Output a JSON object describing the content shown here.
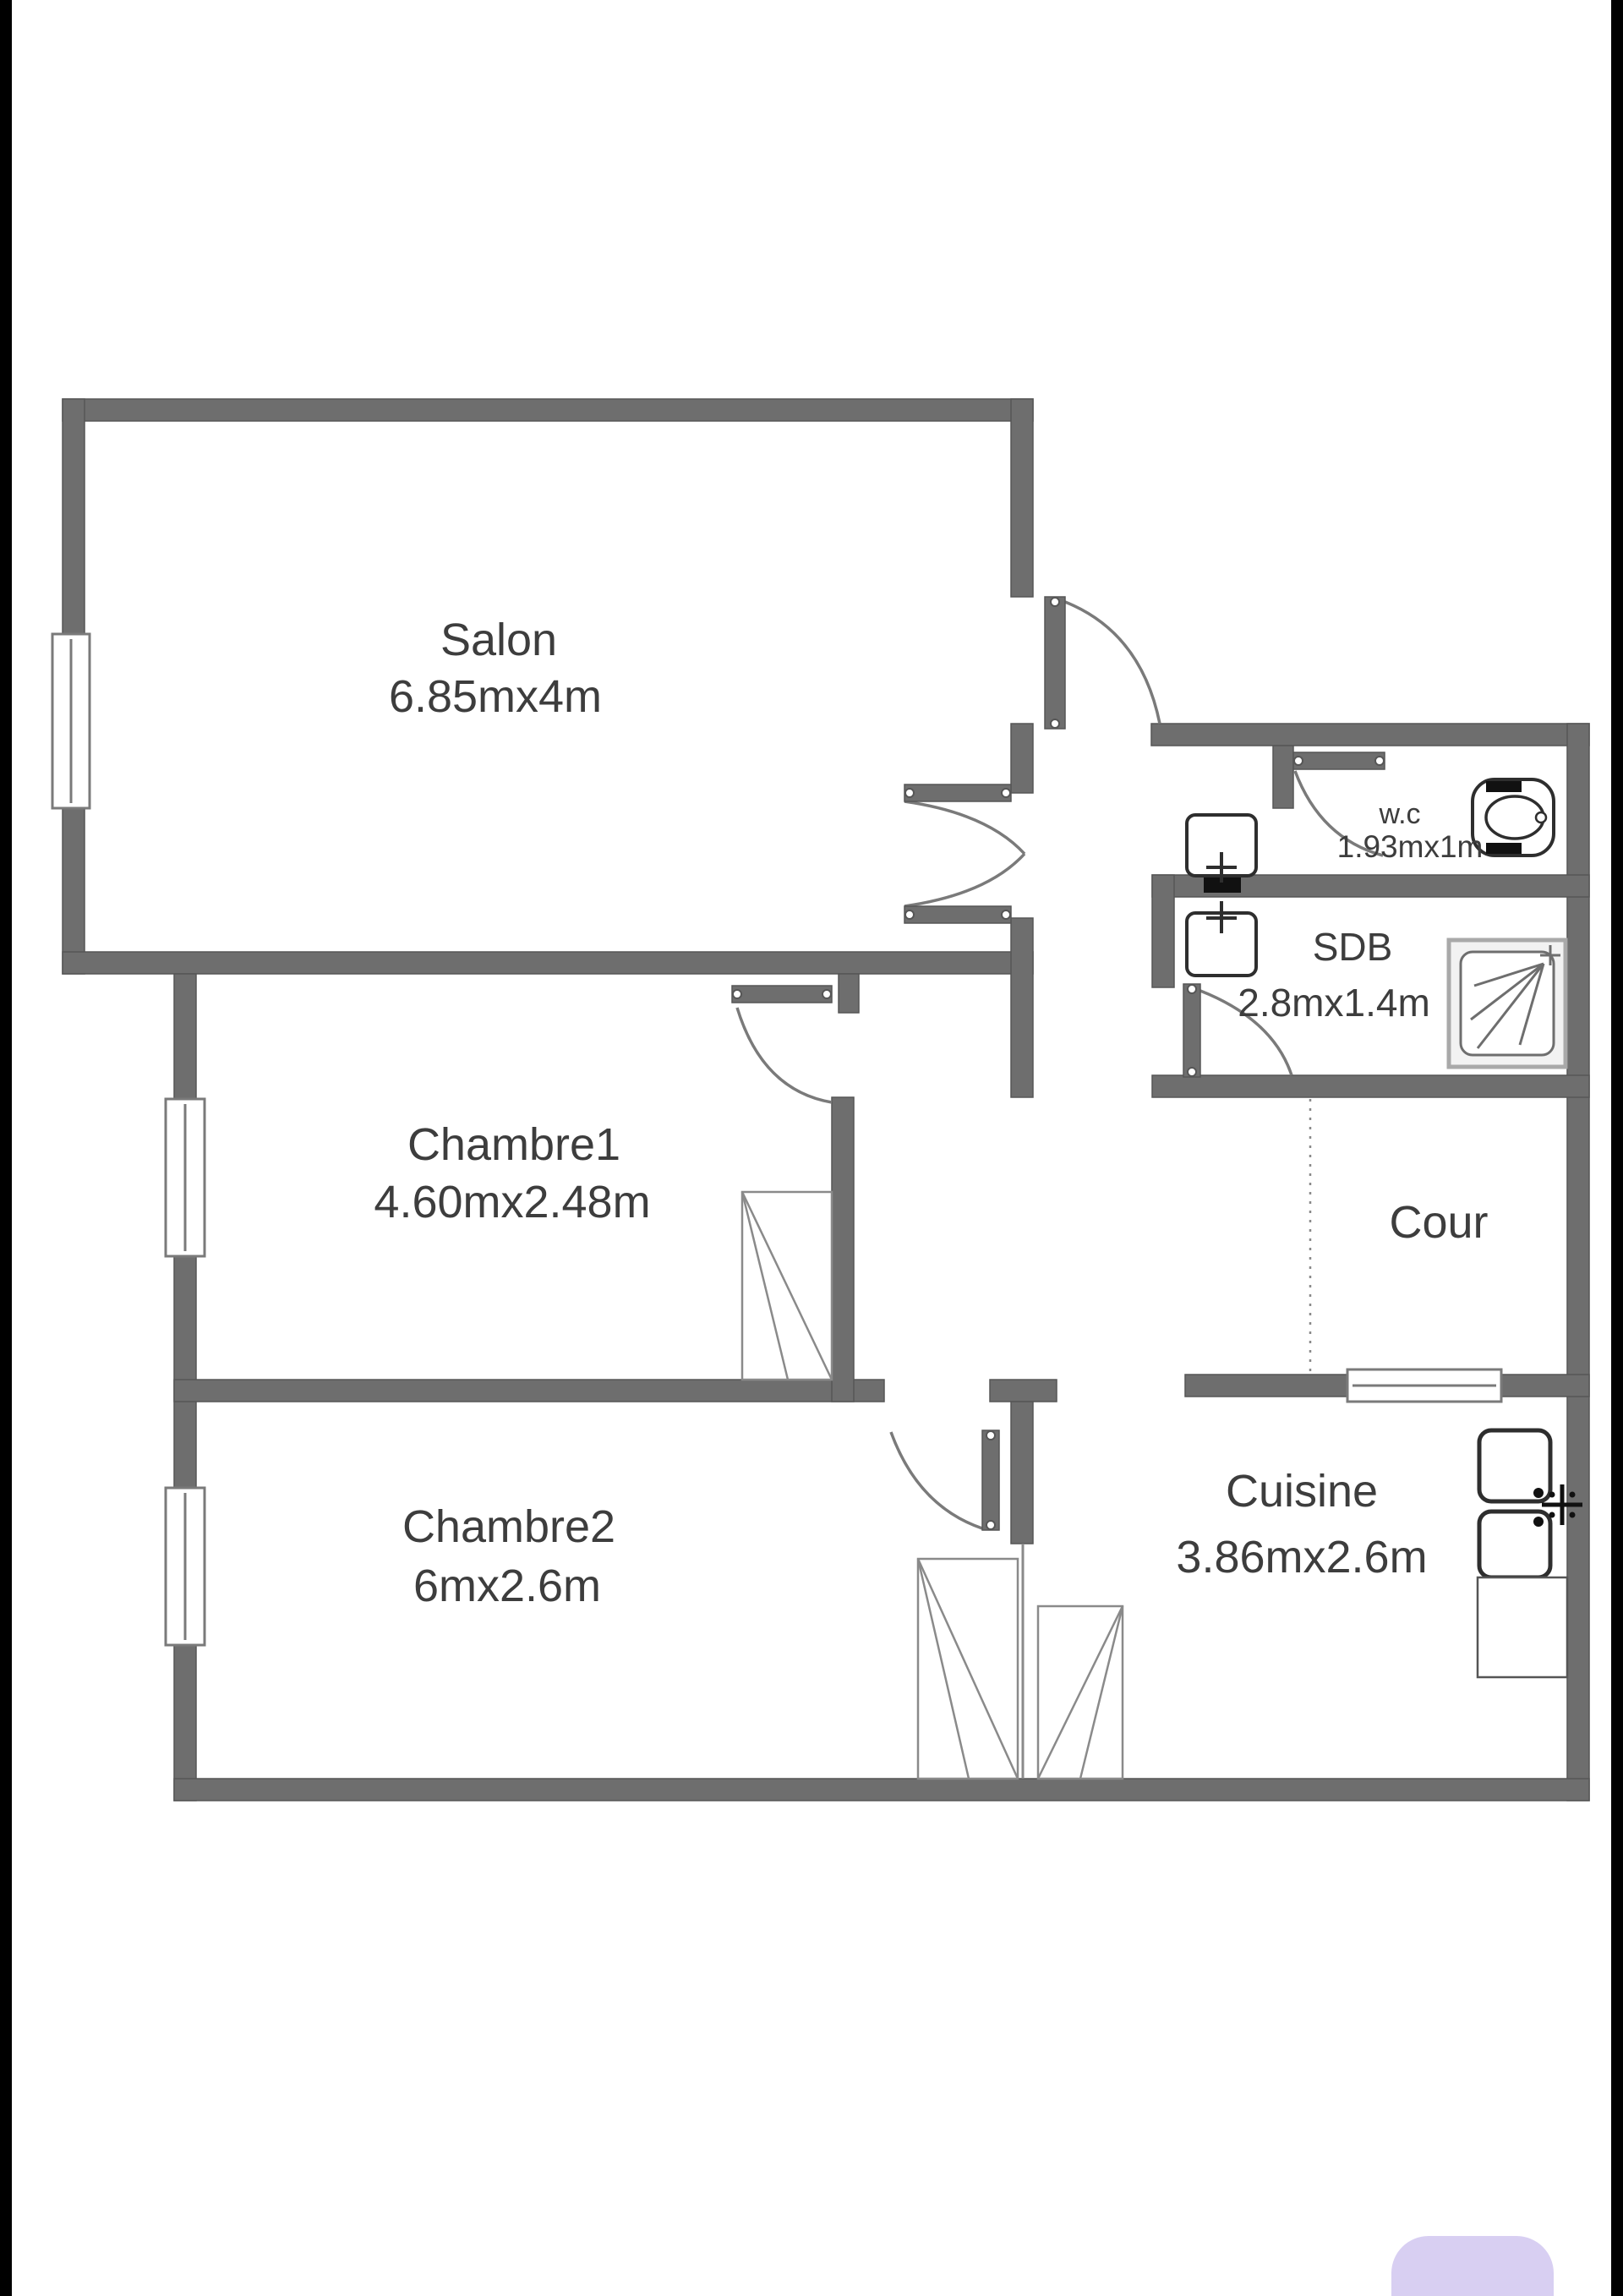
{
  "floor_plan": {
    "rooms": [
      {
        "id": "salon",
        "label": "Salon",
        "dimensions": "6.85mx4m"
      },
      {
        "id": "chambre1",
        "label": "Chambre1",
        "dimensions": "4.60mx2.48m"
      },
      {
        "id": "chambre2",
        "label": "Chambre2",
        "dimensions": "6mx2.6m"
      },
      {
        "id": "cuisine",
        "label": "Cuisine",
        "dimensions": "3.86mx2.6m"
      },
      {
        "id": "sdb",
        "label": "SDB",
        "dimensions": "2.8mx1.4m"
      },
      {
        "id": "wc",
        "label": "w.c",
        "dimensions": "1.93mx1m"
      },
      {
        "id": "cour",
        "label": "Cour",
        "dimensions": ""
      }
    ],
    "fixtures": [
      {
        "icon": "toilet-icon",
        "room": "wc"
      },
      {
        "icon": "washbasin-icon",
        "room": "wc"
      },
      {
        "icon": "washbasin-icon",
        "room": "sdb"
      },
      {
        "icon": "shower-icon",
        "room": "sdb"
      },
      {
        "icon": "kitchen-sink-icon",
        "room": "cuisine"
      },
      {
        "icon": "counter-icon",
        "room": "cuisine"
      },
      {
        "icon": "wardrobe-icon",
        "room": "chambre1"
      },
      {
        "icon": "wardrobe-icon",
        "room": "chambre2"
      },
      {
        "icon": "wardrobe-icon",
        "room": "cuisine"
      }
    ],
    "windows_count": 4,
    "doors_count": 6
  },
  "colors": {
    "wall": "#6e6e6e",
    "wall_edge": "#565656",
    "thin_line": "#8a8a8a",
    "text": "#3d3d3d",
    "background": "#ffffff",
    "screen_edge_bar": "#000000",
    "accent_button": "#d8cff2"
  }
}
